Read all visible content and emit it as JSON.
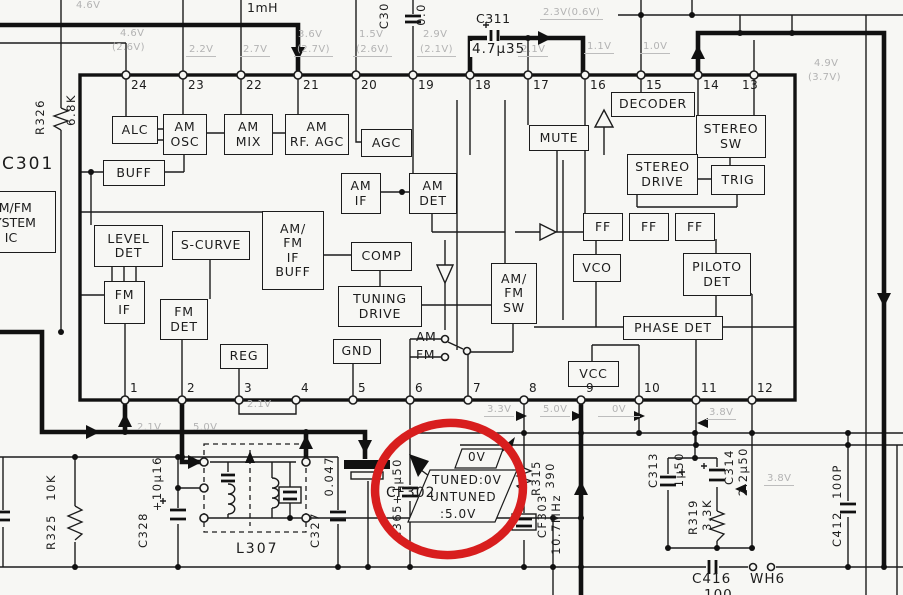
{
  "colors": {
    "bg": "#f7f7f4",
    "ink": "#1c1c1c",
    "faint": "#b3b3b3",
    "highlight_red": "#d81e1e"
  },
  "ic": {
    "ref": "C301",
    "name": "AM/FM\nSYSTEM\nIC",
    "pins_top": [
      "24",
      "23",
      "22",
      "21",
      "20",
      "19",
      "18",
      "17",
      "16",
      "15",
      "14",
      "13"
    ],
    "pins_bottom": [
      "1",
      "2",
      "3",
      "4",
      "5",
      "6",
      "7",
      "8",
      "9",
      "10",
      "11",
      "12"
    ],
    "blocks": {
      "alc": "ALC",
      "am_osc": "AM\nOSC",
      "am_mix": "AM\nMIX",
      "am_rf_agc": "AM\nRF. AGC",
      "agc": "AGC",
      "buff": "BUFF",
      "mute": "MUTE",
      "decoder": "DECODER",
      "stereo_sw": "STEREO\nSW",
      "stereo_drive": "STEREO\nDRIVE",
      "trig": "TRIG",
      "am_if": "AM\nIF",
      "am_det": "AM\nDET",
      "level_det": "LEVEL\nDET",
      "s_curve": "S-CURVE",
      "if_buff": "AM/\nFM\nIF\nBUFF",
      "comp": "COMP",
      "ff1": "FF",
      "ff2": "FF",
      "ff3": "FF",
      "vco": "VCO",
      "piloto_det": "PILOTO\nDET",
      "fm_if": "FM\nIF",
      "fm_det": "FM\nDET",
      "tuning_drive": "TUNING\nDRIVE",
      "amfm_sw": "AM/\nFM\nSW",
      "phase_det": "PHASE DET",
      "reg": "REG",
      "gnd": "GND",
      "vcc": "VCC"
    },
    "switch": {
      "am": "AM",
      "fm": "FM"
    }
  },
  "top": {
    "inductor": "1mH",
    "c309_ref": "C30",
    "c309_val": "0.0",
    "c311_ref": "C311",
    "c311_val": "4.7μ35"
  },
  "v": {
    "tl": "4.6V",
    "p24a": "4.6V",
    "p24b": "(2.6V)",
    "p23": "2.2V",
    "p22": "2.7V",
    "p21a": "3.6V",
    "p21b": "(2.7V)",
    "p20a": "1.5V",
    "p20b": "(2.6V)",
    "p19a": "2.9V",
    "p19b": "(2.1V)",
    "p18": "2.3V(0.6V)",
    "p17": "2.1V",
    "p16": "1.1V",
    "p15": "1.0V",
    "p13a": "4.9V",
    "p13b": "(3.7V)",
    "b3": "2.1V",
    "bl1": "2.1V",
    "bl2": "5.0V",
    "b7": "3.3V",
    "b8": "5.0V",
    "b9": "0V",
    "b11": "3.8V",
    "c314": "3.8V"
  },
  "hl": {
    "v0": "0V",
    "l1": "TUNED:0V",
    "l2": "UNTUNED",
    "l3": ":5.0V"
  },
  "comp": {
    "r326_ref": "R326",
    "r326_val": "6.8K",
    "r325_ref": "R325",
    "r325_val": "10K",
    "c328_ref": "C328",
    "c328_val": "+10μ16",
    "c327_ref": "C327",
    "c327_val": "0.047",
    "cf302": "CF302",
    "l307": "L307",
    "c365_ref": "C365",
    "c365_val": "+1μ50",
    "r315_ref": "R315",
    "r315_val": "390",
    "cf303_ref": "CF303",
    "cf303_val": "10.7MHz",
    "c313_ref": "C313",
    "c313_val": "1μ50",
    "r319_ref": "R319",
    "r319_val": "3.3K",
    "c314_ref": "C314",
    "c314_val": "2.2μ50",
    "c412_ref": "C412",
    "c412_val": "100P",
    "c416_ref": "C416",
    "c416_val": "100",
    "wh6": "WH6"
  }
}
